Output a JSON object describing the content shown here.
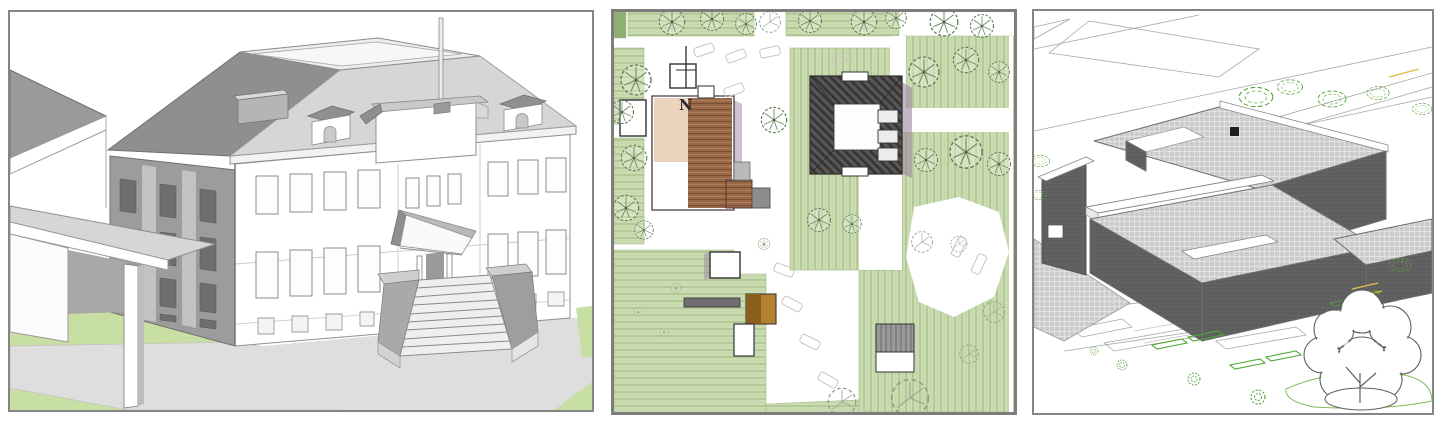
{
  "page": {
    "background": "#ffffff"
  },
  "panels": [
    {
      "name": "perspective-massing-model",
      "type": "3d-sketch-render"
    },
    {
      "name": "watercolor-site-plan",
      "type": "hand-drawn-plan",
      "north_label": "N"
    },
    {
      "name": "axonometric-site-drawing",
      "type": "cad-line-drawing"
    }
  ],
  "colors": {
    "frame_gray": "#858585",
    "lawn_green": "#c8dfa3",
    "walkway_gray": "#dedede",
    "roof_dark": "#8f8f8f",
    "roof_light": "#d6d6d6",
    "wall_white": "#ffffff",
    "plan_green": "#cbdcb2",
    "plan_green_stroke": "#9fba86",
    "plan_brown": "#9c6a49",
    "plan_peach": "#ecd3bd",
    "plan_dark": "#4e4c4a",
    "shadow_purple": "#9b86a0",
    "cad_line": "#a7a7a7",
    "cad_green": "#4ea832",
    "cad_yellow": "#dec04a",
    "hatch_light": "#cdcdcd",
    "hatch_dark": "#5d5d5d"
  }
}
